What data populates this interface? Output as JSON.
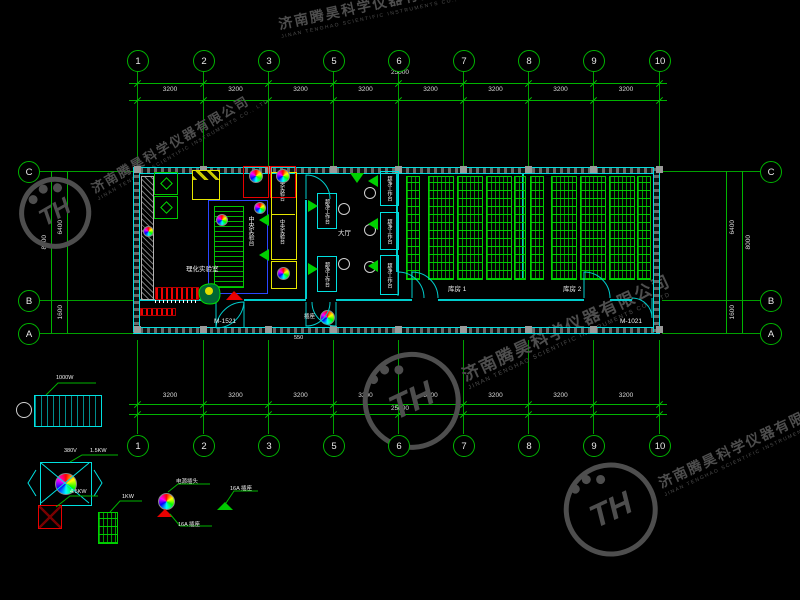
{
  "watermark": {
    "cn": "济南腾昊科学仪器有限公司",
    "en": "JINAN TENGHAO SCIENTIFIC INSTRUMENTS CO., LTD",
    "monogram": "TH"
  },
  "axes": {
    "top": [
      "1",
      "2",
      "3",
      "5",
      "6",
      "7",
      "8",
      "9",
      "10"
    ],
    "bottom": [
      "1",
      "2",
      "3",
      "5",
      "6",
      "7",
      "8",
      "9",
      "10"
    ],
    "left": [
      "C",
      "B",
      "A"
    ],
    "right": [
      "C",
      "B",
      "A"
    ]
  },
  "dims": {
    "total": "25000",
    "bays": [
      "3200",
      "3200",
      "3200",
      "3200",
      "3200",
      "3200",
      "3200",
      "3200"
    ],
    "side_total": "8000",
    "side_upper": "6400",
    "side_lower": "1600",
    "door_dim": "550"
  },
  "plan": {
    "door_left": "M-1521",
    "door_right": "M-1021",
    "lab_label": "理化实验室",
    "hall_label": "大厅",
    "storage1_label": "库房 1",
    "storage2_label": "库房 2",
    "center_bench": "中央实验台",
    "side_bench": "中央实验台",
    "clean_bench": "超净工作台",
    "entry_socket": "插座"
  },
  "legend": {
    "uv_power": "1000W",
    "fan_voltage": "380V",
    "fan_power": "1.5KW",
    "heater_power": "4.5KW",
    "rack_power": "1KW",
    "plug_label": "电源插头",
    "plug_socket": "16A 插座",
    "socket_label": "16A 插座"
  }
}
